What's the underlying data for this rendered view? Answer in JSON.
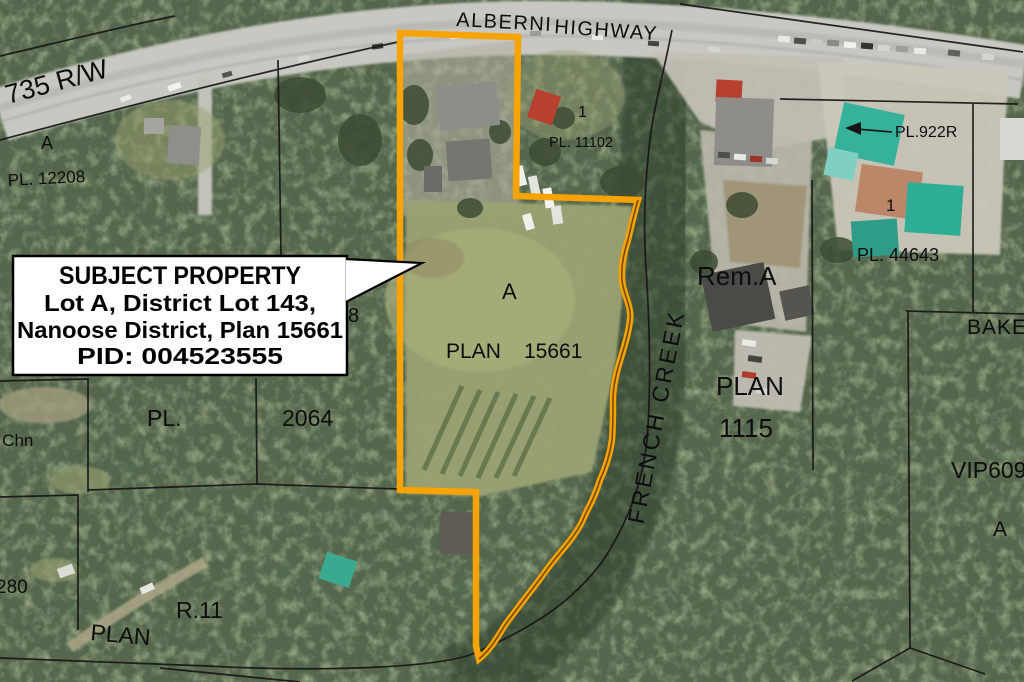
{
  "colors": {
    "boundary": "#F7A301",
    "creek_centerline": "#7a4a00",
    "parcel_line": "#161616",
    "callout_bg": "#FFFFFF",
    "callout_border": "#000000"
  },
  "callout": {
    "line1": "SUBJECT PROPERTY",
    "line2": "Lot A, District Lot 143,",
    "line3": "Nanoose District, Plan 15661",
    "line4": "PID: 004523555"
  },
  "labels": {
    "alberni": "ALBERNI",
    "highway": "HIGHWAY",
    "rw_735": "735 R/W",
    "parcel_a_nw": "A",
    "pl_12208": "PL. 12208",
    "lot_1_n": "1",
    "pl_11102": "PL. 11102",
    "pl_922r": "PL.922R",
    "lot_1_ne": "1",
    "pl_44643": "PL. 44643",
    "rem_a": "Rem.A",
    "bake": "BAKE",
    "parcel_a_center": "A",
    "plan_center": "PLAN",
    "plan_center_num": "15661",
    "french_creek": "FRENCH CREEK",
    "plan_e": "PLAN",
    "plan_e_num": "1115",
    "vip_609": "VIP609",
    "parcel_a_se": "A",
    "pl_w": "PL.",
    "num_2064": "2064",
    "num_280": "280",
    "r_11": "R.11",
    "plan_sw": "PLAN",
    "chn": "3 Chn",
    "partial_8": "8"
  }
}
